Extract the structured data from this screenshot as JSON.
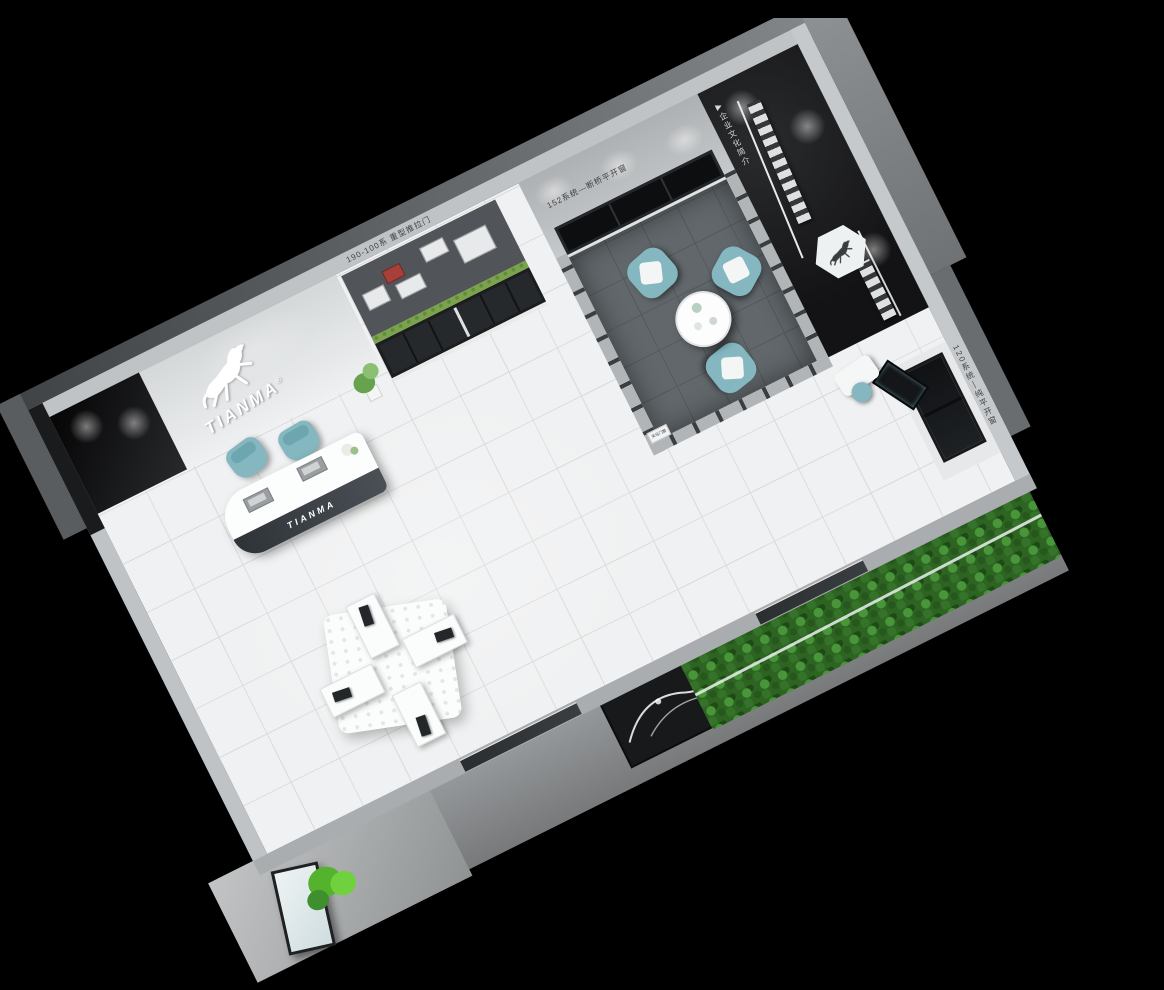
{
  "branding": {
    "logo_text": "TIANMA",
    "logo_trademark": "®",
    "logo_icon": "horse-icon",
    "reception_desk_text": "TIANMA"
  },
  "wall_labels": {
    "sliding_door_bay": "190-100系 重型推拉门",
    "window_system_beam": "152系统—断桥平开窗",
    "culture_wall": "企业文化简介",
    "culture_marker_glyph": "▶",
    "casement_bay": "120系统—纯平开窗",
    "partition_sign": "天马门窗"
  },
  "colors": {
    "background": "#000000",
    "floor_tile": "#f0f1f2",
    "floor_grout": "#d9dcdd",
    "wall_light": "#bfc2c4",
    "wall_dark": "#141416",
    "meeting_room_floor": "#61676b",
    "teal_furniture": "#84b7c0",
    "plant_green": "#54b22c",
    "hedge_green": "#2d6422",
    "frame_black": "#1d1f21",
    "exterior_walkway": "#8e9193",
    "desk_front_panel": "#373c41"
  }
}
